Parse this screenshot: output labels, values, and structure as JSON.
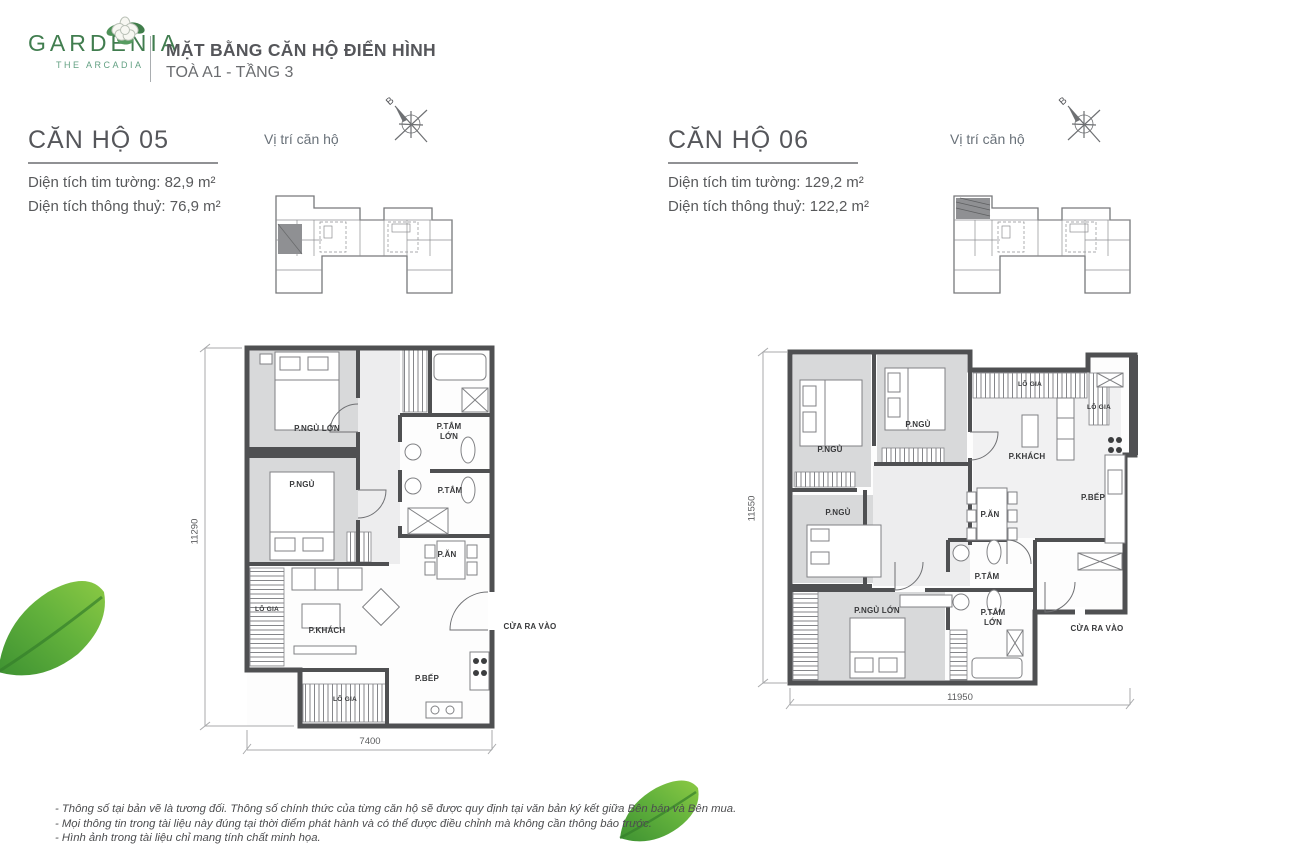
{
  "header": {
    "brand": "GARDENIA",
    "brand_sub": "THE ARCADIA",
    "title": "MẶT BẰNG CĂN HỘ ĐIỂN HÌNH",
    "subtitle": "TOÀ A1 - TẦNG 3"
  },
  "units": [
    {
      "name": "CĂN HỘ 05",
      "area1_label": "Diện tích tim tường:",
      "area1_value": "82,9 m²",
      "area2_label": "Diện tích thông thuỷ:",
      "area2_value": "76,9 m²",
      "position_label": "Vị trí căn hộ",
      "compass_north": "B",
      "dims": {
        "height": "11290",
        "width": "7400"
      },
      "rooms": {
        "master_bedroom": "P.NGỦ LỚN",
        "master_bath": "P.TẮM LỚN",
        "bedroom": "P.NGỦ",
        "bath": "P.TẮM",
        "dining": "P.ĂN",
        "balcony_side": "LÔ GIA",
        "living": "P.KHÁCH",
        "kitchen": "P.BẾP",
        "balcony_bottom": "LÔ GIA",
        "entrance": "CỬA RA VÀO"
      }
    },
    {
      "name": "CĂN HỘ 06",
      "area1_label": "Diện tích tim tường:",
      "area1_value": "129,2 m²",
      "area2_label": "Diện tích thông thuỷ:",
      "area2_value": "122,2 m²",
      "position_label": "Vị trí căn hộ",
      "compass_north": "B",
      "dims": {
        "height": "11550",
        "width": "11950"
      },
      "rooms": {
        "bedroom1": "P.NGỦ",
        "bedroom2": "P.NGỦ",
        "balcony_top": "LÔ GIA",
        "balcony_right": "LÔ GIA",
        "living": "P.KHÁCH",
        "bedroom3": "P.NGỦ",
        "dining": "P.ĂN",
        "kitchen": "P.BẾP",
        "bath": "P.TẮM",
        "master_bedroom": "P.NGỦ LỚN",
        "master_bath": "P.TẮM LỚN",
        "entrance": "CỬA RA VÀO"
      }
    }
  ],
  "footnotes": [
    "- Thông số tại bản vẽ là tương đối. Thông số chính thức của từng căn hộ sẽ được quy định tại văn bản ký kết giữa Bên bán và Bên mua.",
    "- Mọi thông tin trong tài liệu này đúng tại thời điểm phát hành và có thể được điều chỉnh mà không cần thông báo trước.",
    "- Hình ảnh trong tài liệu chỉ mang tính chất minh họa."
  ],
  "colors": {
    "brand_green": "#417d4f",
    "text_dark": "#57585a",
    "wall": "#4f5052",
    "bedroom_fill": "#d8d9da"
  }
}
